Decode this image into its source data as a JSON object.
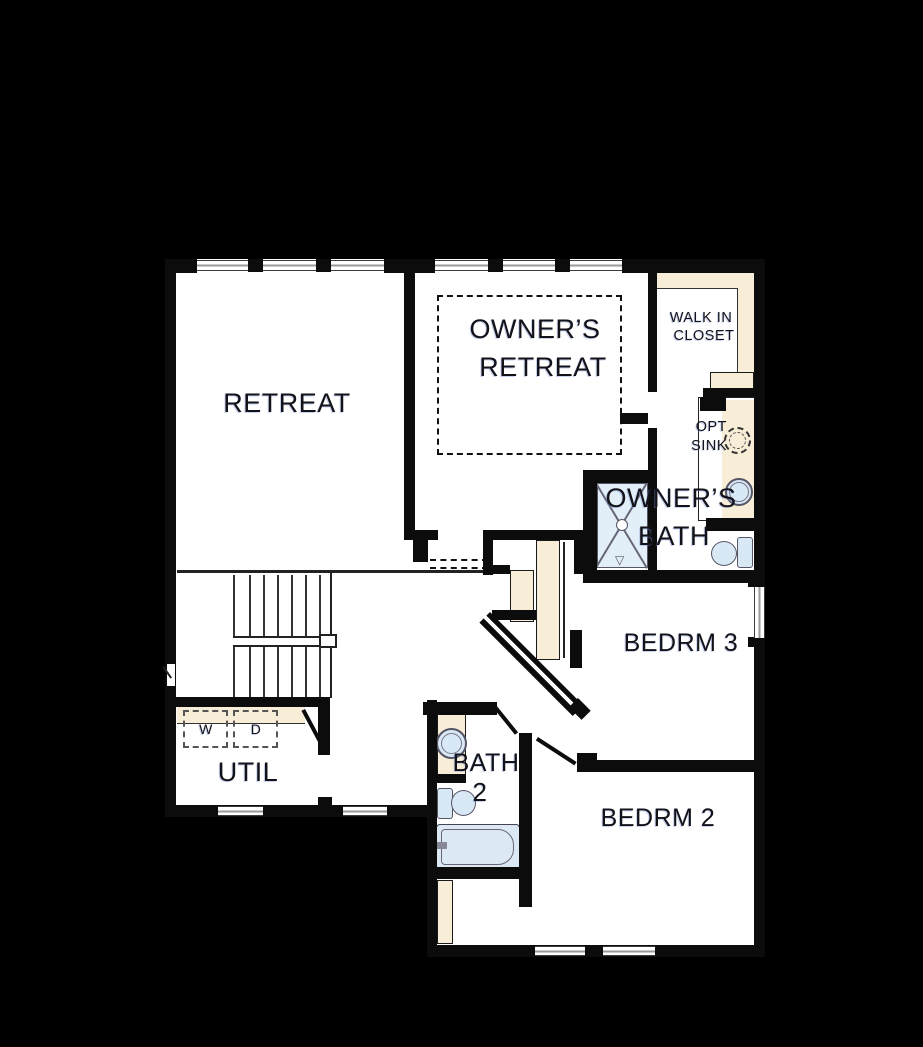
{
  "plan_title": "second-floor-plan",
  "colors": {
    "background": "#000000",
    "floor": "#ffffff",
    "wall": "#0c0c0c",
    "counter_beige": "#f8eed8",
    "fixture_blue": "#d9e8f5",
    "window_gray": "#9a9a9a",
    "label_ink": "#121218"
  },
  "rooms": {
    "retreat": {
      "label": "RETREAT"
    },
    "owners_retreat": {
      "line1": "OWNER’S",
      "line2": "RETREAT"
    },
    "walk_in_closet": {
      "line1": "WALK IN",
      "line2": "CLOSET"
    },
    "opt_sink": {
      "line1": "OPT",
      "line2": "SINK"
    },
    "owners_bath": {
      "line1": "OWNER’S",
      "line2": "BATH"
    },
    "bedrm3": {
      "label": "BEDRM 3"
    },
    "bath2": {
      "line1": "BATH",
      "line2": "2"
    },
    "bedrm2": {
      "label": "BEDRM 2"
    },
    "util": {
      "label": "UTIL"
    }
  },
  "appliances": {
    "washer": "W",
    "dryer": "D"
  },
  "fixtures": [
    "shower",
    "owners-toilet",
    "owners-sink",
    "optional-sink",
    "bath2-sink",
    "bath2-toilet",
    "bathtub",
    "washer",
    "dryer",
    "staircase",
    "tray-ceiling-dashed",
    "linen-closet",
    "walk-in-closet-shelves"
  ]
}
